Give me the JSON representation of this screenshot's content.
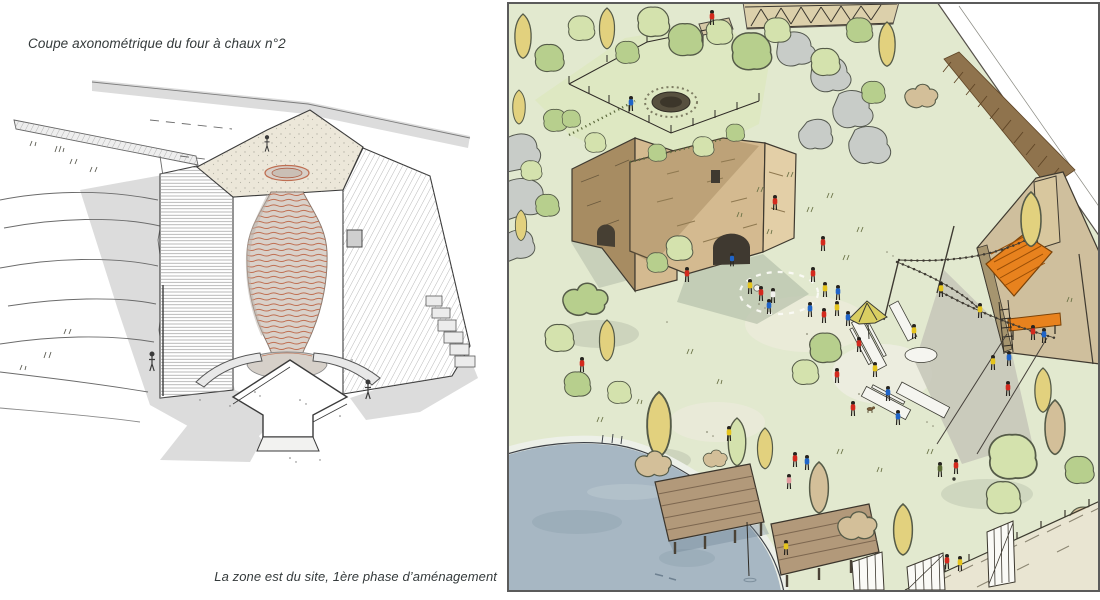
{
  "figures": {
    "kiln_section": {
      "caption": "Coupe axonométrique du four à chaux n°2",
      "subject": "axonometric-cutaway-of-lime-kiln-number-2"
    },
    "site_view": {
      "caption": "La zone est du site, 1ère phase d’aménagement",
      "subject": "aerial-sketch-of-east-zone-first-phase"
    }
  },
  "colors": {
    "caption_text": "#343a3b",
    "ink": "#3b3b3b",
    "shadow_gray": "#dcdcdc",
    "platform_cream": "#ece7d9",
    "flue_red": "#bf6f52",
    "flue_fill": "#d9d1ca",
    "lawn": "#e2e9cf",
    "lawn_shade": "#c9d6ab",
    "shadow_green": "#b7c0ab",
    "water": "#a7b7c3",
    "shore": "#edf0e8",
    "stone_light": "#d4ba90",
    "stone_dark": "#a78c62",
    "wood_deck": "#b2997a",
    "stage_orange": "#e8821e",
    "tree_green": "#b7cf8d",
    "tree_light": "#d4e2ad",
    "tree_yellow": "#e2d17e",
    "tree_beige": "#d3bf99",
    "rock_gray": "#c8ccc8",
    "person_red": "#d3291d",
    "person_blue": "#1f64c8",
    "person_yellow": "#e5c41d",
    "table_white": "#f5f5f0",
    "border": "#5b5b5b"
  }
}
